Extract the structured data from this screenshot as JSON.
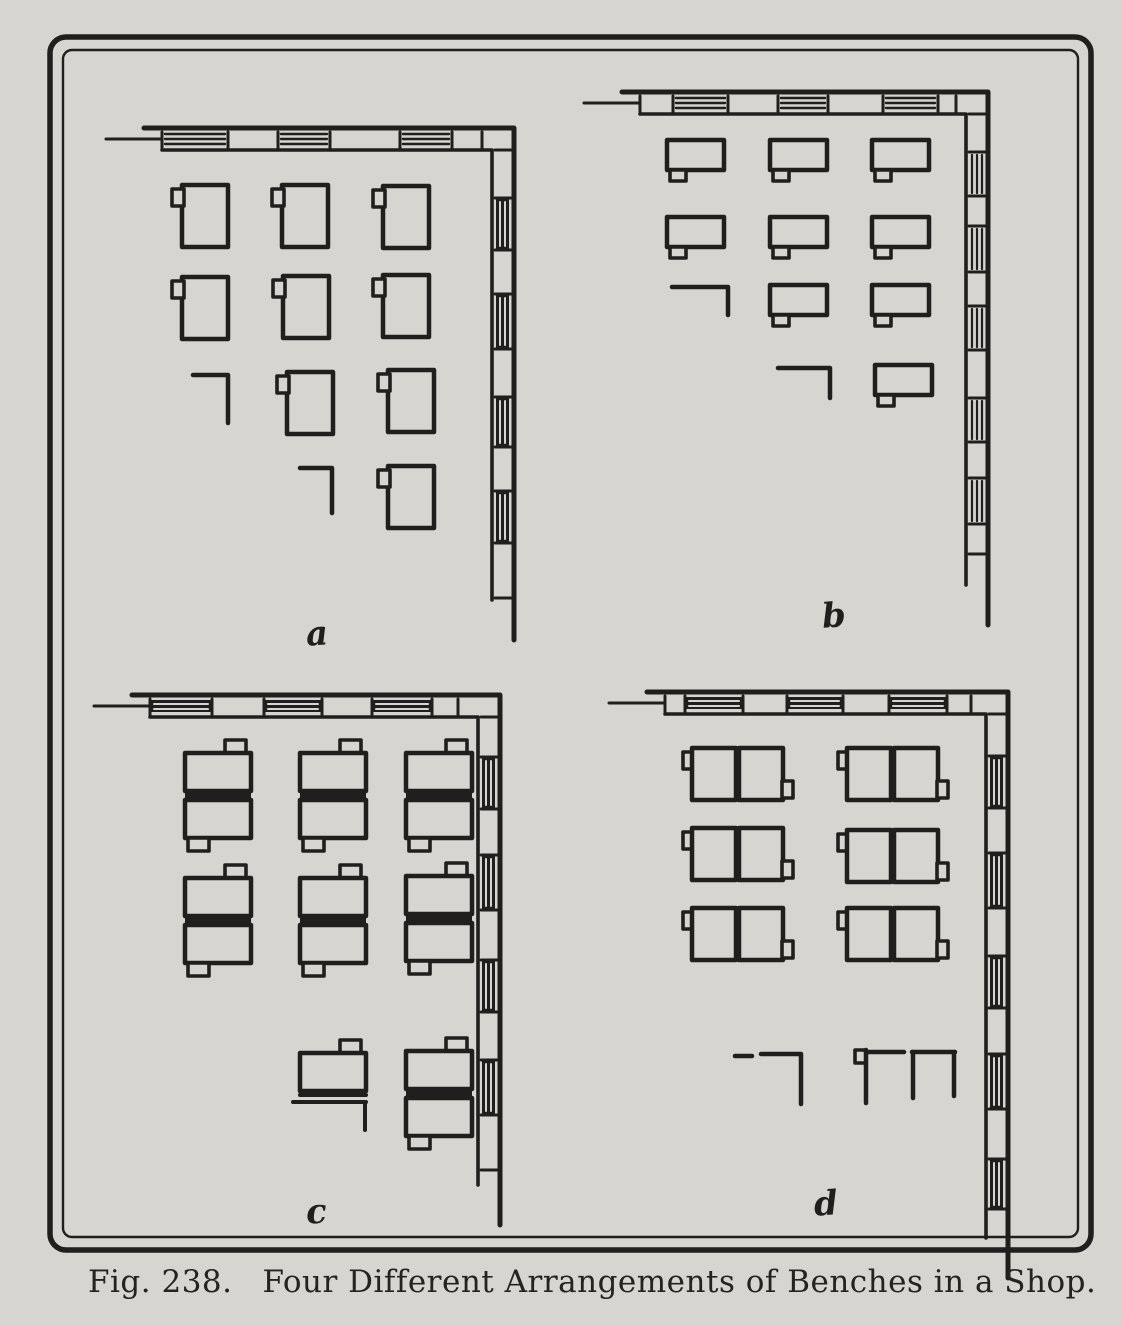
{
  "caption": {
    "fig_label": "Fig. 238.",
    "title": "Four Different Arrangements of Benches in a Shop."
  },
  "colors": {
    "paper": "#d7d5d1",
    "ink": "#201f1d",
    "caption_ink": "#26231f"
  },
  "figure": {
    "border": {
      "outer": [
        50,
        37,
        1041,
        1213
      ],
      "inner": [
        63,
        50,
        1015,
        1187
      ],
      "outer_radius": 16,
      "inner_radius": 9
    },
    "panels": [
      {
        "id": "a",
        "label": "a",
        "label_pos": [
          306,
          614
        ],
        "wall": {
          "xe": 514,
          "cy": 128,
          "t": 22,
          "xs": 152,
          "yEnd": 600,
          "top_shade": 0,
          "right_shade": 1,
          "top_segs": [
            [
              "w",
              66
            ],
            [
              "p",
              50
            ],
            [
              "w",
              52
            ],
            [
              "p",
              70
            ],
            [
              "w",
              52
            ],
            [
              "p",
              30
            ]
          ],
          "right_segs": [
            [
              "p",
              48
            ],
            [
              "w",
              52
            ],
            [
              "p",
              44
            ],
            [
              "w",
              55
            ],
            [
              "p",
              48
            ],
            [
              "w",
              50
            ],
            [
              "p",
              44
            ],
            [
              "w",
              52
            ],
            [
              "p",
              55
            ]
          ]
        },
        "items": [
          {
            "t": "benchA",
            "x": 182,
            "y": 185
          },
          {
            "t": "benchA",
            "x": 282,
            "y": 185
          },
          {
            "t": "benchA",
            "x": 383,
            "y": 186
          },
          {
            "t": "benchA",
            "x": 182,
            "y": 277
          },
          {
            "t": "benchA",
            "x": 283,
            "y": 276
          },
          {
            "t": "benchA",
            "x": 383,
            "y": 275
          },
          {
            "t": "corner",
            "x": 193,
            "y": 375,
            "l1": 35,
            "l2": 48
          },
          {
            "t": "benchA",
            "x": 287,
            "y": 372
          },
          {
            "t": "benchA",
            "x": 388,
            "y": 370
          },
          {
            "t": "corner",
            "x": 300,
            "y": 468,
            "l1": 32,
            "l2": 45
          },
          {
            "t": "benchA",
            "x": 388,
            "y": 466
          }
        ]
      },
      {
        "id": "b",
        "label": "b",
        "label_pos": [
          822,
          596
        ],
        "wall": {
          "xe": 988,
          "cy": 92,
          "t": 22,
          "xs": 630,
          "yEnd": 585,
          "top_shade": 0,
          "right_shade": 0,
          "top_segs": [
            [
              "p",
              33
            ],
            [
              "w",
              55
            ],
            [
              "p",
              50
            ],
            [
              "w",
              50
            ],
            [
              "p",
              55
            ],
            [
              "w",
              55
            ],
            [
              "p",
              18
            ]
          ],
          "right_segs": [
            [
              "p",
              38
            ],
            [
              "w",
              44
            ],
            [
              "p",
              30
            ],
            [
              "w",
              46
            ],
            [
              "p",
              34
            ],
            [
              "w",
              44
            ],
            [
              "p",
              48
            ],
            [
              "w",
              44
            ],
            [
              "p",
              36
            ],
            [
              "w",
              46
            ],
            [
              "p",
              30
            ]
          ]
        },
        "items": [
          {
            "t": "benchB",
            "x": 667,
            "y": 140
          },
          {
            "t": "benchB",
            "x": 770,
            "y": 140
          },
          {
            "t": "benchB",
            "x": 872,
            "y": 140
          },
          {
            "t": "benchB",
            "x": 667,
            "y": 217
          },
          {
            "t": "benchB",
            "x": 770,
            "y": 217
          },
          {
            "t": "benchB",
            "x": 872,
            "y": 217
          },
          {
            "t": "corner",
            "x": 672,
            "y": 287,
            "l1": 56,
            "l2": 28
          },
          {
            "t": "benchB",
            "x": 770,
            "y": 285
          },
          {
            "t": "benchB",
            "x": 872,
            "y": 285
          },
          {
            "t": "corner",
            "x": 778,
            "y": 368,
            "l1": 52,
            "l2": 30
          },
          {
            "t": "benchB",
            "x": 875,
            "y": 365
          }
        ]
      },
      {
        "id": "c",
        "label": "c",
        "label_pos": [
          306,
          1192
        ],
        "wall": {
          "xe": 500,
          "cy": 695,
          "t": 22,
          "xs": 140,
          "yEnd": 1185,
          "top_shade": 1,
          "right_shade": 1,
          "top_segs": [
            [
              "w",
              62
            ],
            [
              "p",
              52
            ],
            [
              "w",
              58
            ],
            [
              "p",
              50
            ],
            [
              "w",
              60
            ],
            [
              "p",
              26
            ]
          ],
          "right_segs": [
            [
              "p",
              40
            ],
            [
              "w",
              52
            ],
            [
              "p",
              46
            ],
            [
              "w",
              55
            ],
            [
              "p",
              50
            ],
            [
              "w",
              52
            ],
            [
              "p",
              48
            ],
            [
              "w",
              55
            ],
            [
              "p",
              55
            ]
          ]
        },
        "items": [
          {
            "t": "unitC",
            "x": 185,
            "y": 753
          },
          {
            "t": "unitC",
            "x": 300,
            "y": 753
          },
          {
            "t": "unitC",
            "x": 406,
            "y": 753
          },
          {
            "t": "unitC",
            "x": 185,
            "y": 878
          },
          {
            "t": "unitC",
            "x": 300,
            "y": 878
          },
          {
            "t": "unitC",
            "x": 406,
            "y": 876
          },
          {
            "t": "partialC",
            "x": 300,
            "y": 1053
          },
          {
            "t": "unitC",
            "x": 406,
            "y": 1051
          }
        ]
      },
      {
        "id": "d",
        "label": "d",
        "label_pos": [
          814,
          1184
        ],
        "wall": {
          "xe": 1008,
          "cy": 692,
          "t": 22,
          "xs": 655,
          "yEnd": 1238,
          "top_shade": 1,
          "right_shade": 1,
          "top_segs": [
            [
              "p",
              20
            ],
            [
              "w",
              58
            ],
            [
              "p",
              44
            ],
            [
              "w",
              56
            ],
            [
              "p",
              46
            ],
            [
              "w",
              58
            ],
            [
              "p",
              24
            ]
          ],
          "right_segs": [
            [
              "p",
              42
            ],
            [
              "w",
              52
            ],
            [
              "p",
              45
            ],
            [
              "w",
              55
            ],
            [
              "p",
              48
            ],
            [
              "w",
              52
            ],
            [
              "p",
              46
            ],
            [
              "w",
              55
            ],
            [
              "p",
              50
            ],
            [
              "w",
              50
            ]
          ]
        },
        "items": [
          {
            "t": "unitD",
            "x": 692,
            "y": 748
          },
          {
            "t": "unitD",
            "x": 847,
            "y": 748
          },
          {
            "t": "unitD",
            "x": 692,
            "y": 828
          },
          {
            "t": "unitD",
            "x": 847,
            "y": 830
          },
          {
            "t": "unitD",
            "x": 692,
            "y": 908
          },
          {
            "t": "unitD",
            "x": 847,
            "y": 908
          },
          {
            "t": "dash",
            "x": 735,
            "y": 1056,
            "len": 17
          },
          {
            "t": "corner",
            "x": 761,
            "y": 1054,
            "l1": 40,
            "l2": 50
          },
          {
            "t": "partialD",
            "x": 855,
            "y": 1050
          }
        ]
      }
    ]
  }
}
